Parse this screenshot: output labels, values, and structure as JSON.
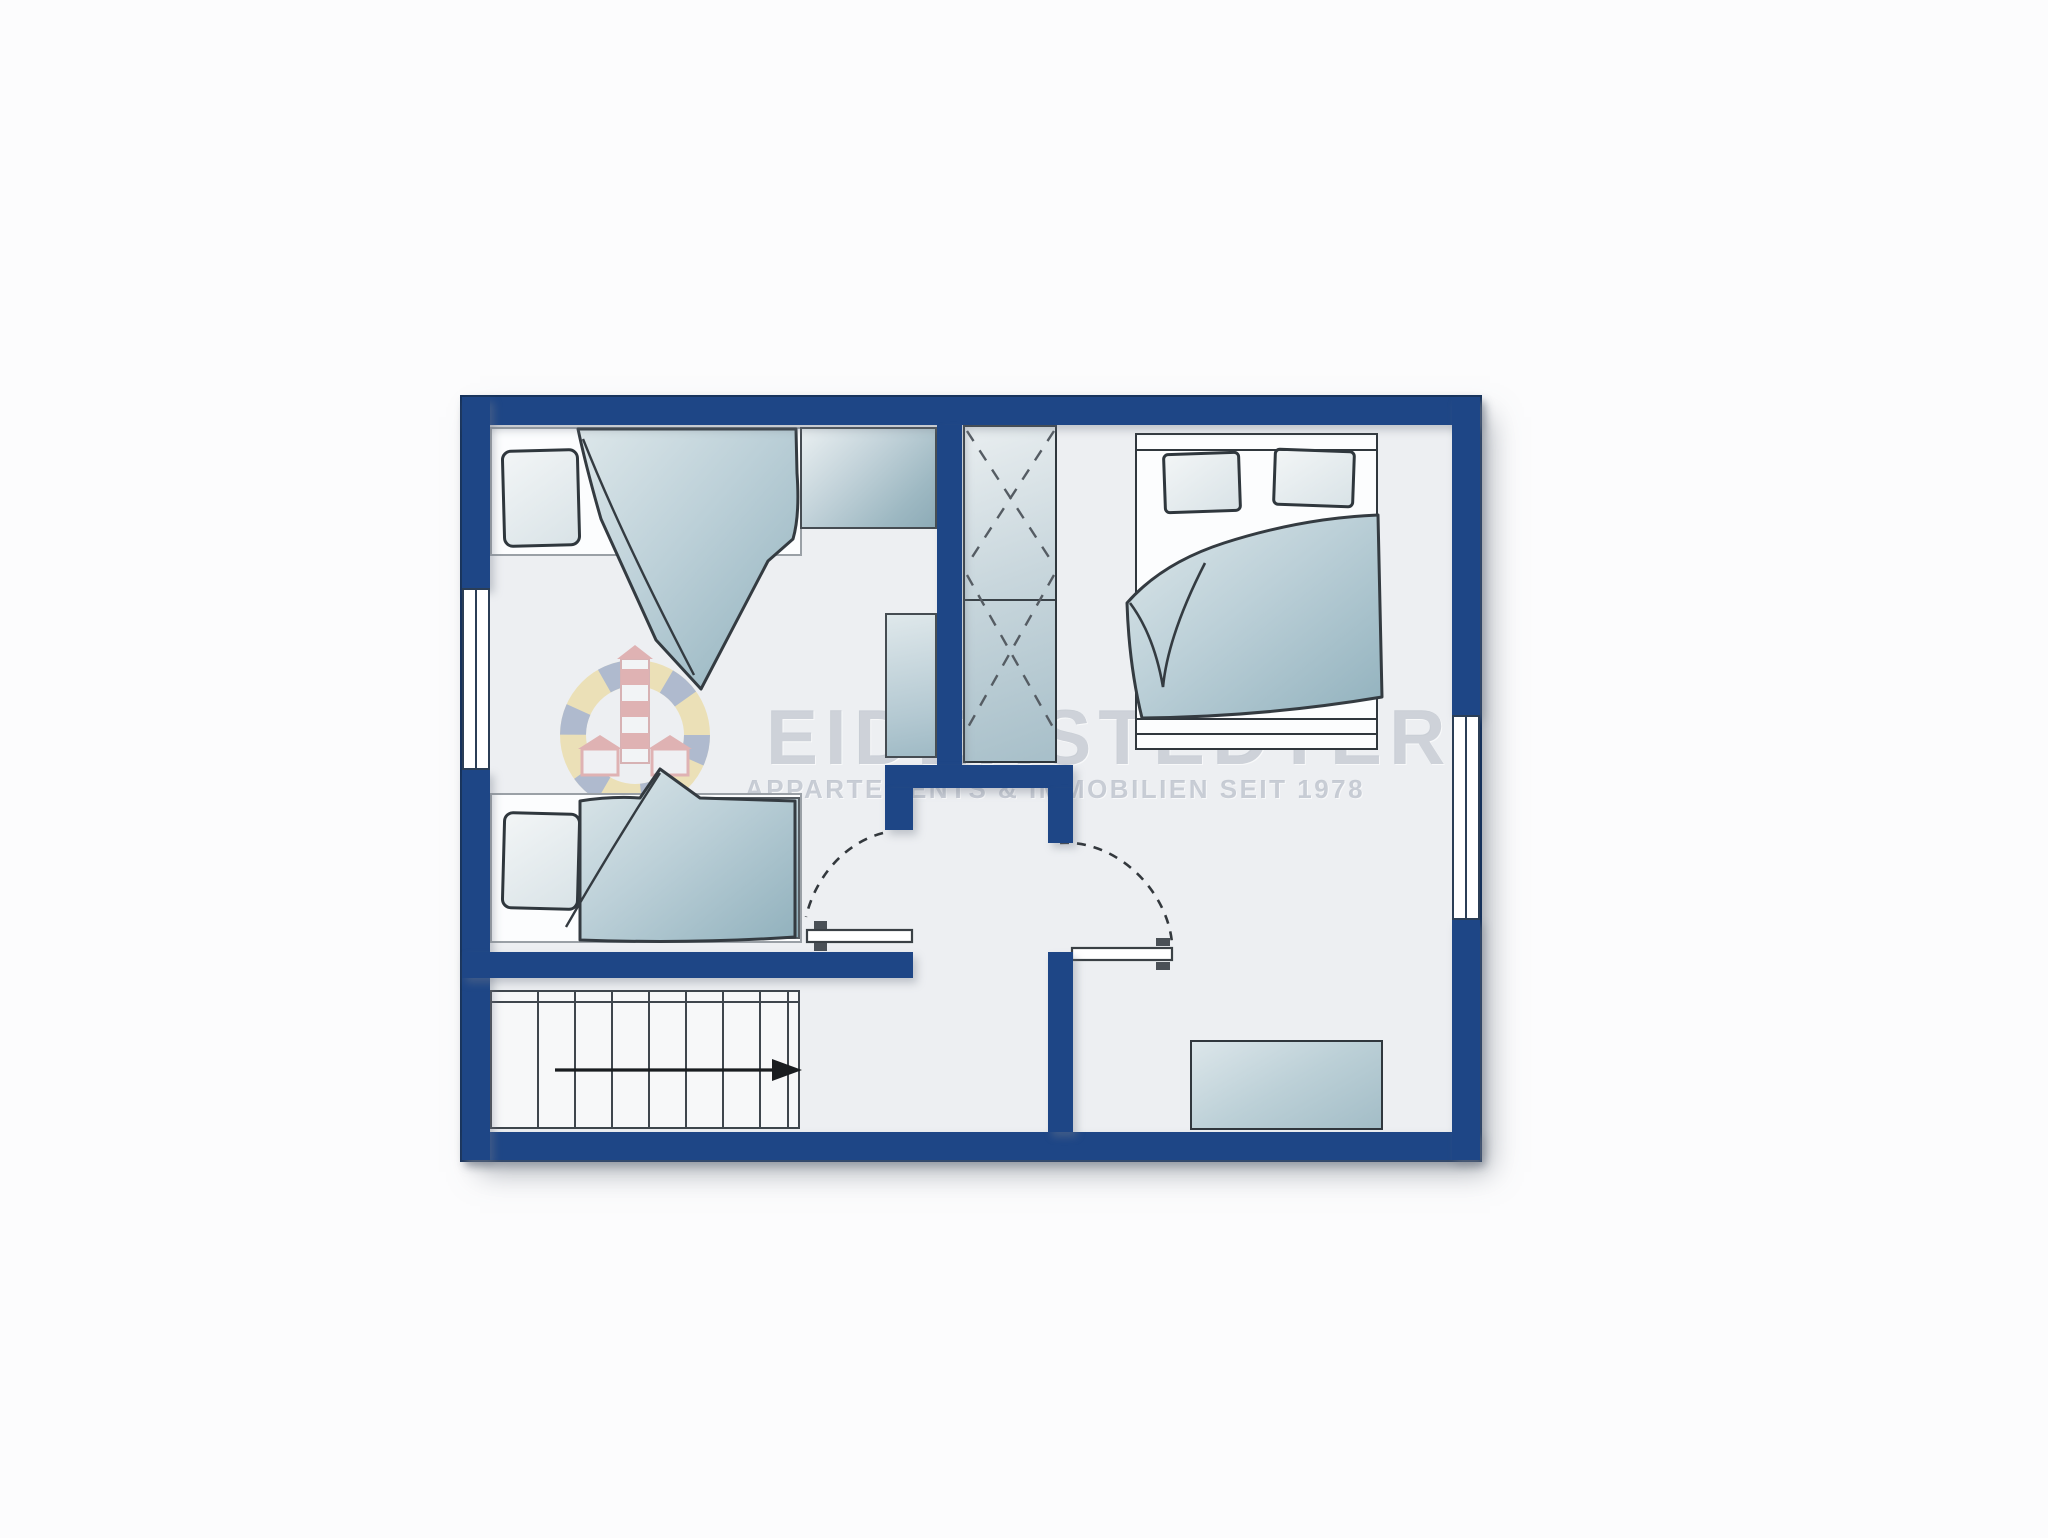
{
  "watermark": {
    "title": "EIDERSTEDTER",
    "subtitle": "APPARTEMENTS & IMMOBILIEN SEIT 1978",
    "logo": "lighthouse-badge-icon"
  },
  "palette": {
    "wall_blue": "#1e4686",
    "wall_outline": "#16325c",
    "floor": "#edeff2",
    "furniture_light": "#e9eff1",
    "furniture_steel": "#8dabb7",
    "ink_outline": "#30373d",
    "watermark_gray": "#abb2be",
    "logo_yellow": "#e8c23f",
    "logo_blue": "#2e4c86",
    "logo_red": "#c23430",
    "background": "#fcfcfd"
  },
  "plan": {
    "type": "floor-plan",
    "storey_elements": {
      "single_beds": 2,
      "double_beds": 1,
      "wardrobe_crossed_cells": 2,
      "dresser": 1,
      "windows": 2,
      "swing_doors": 2,
      "staircase": {
        "tread_lines": 7,
        "arrow_direction": "right"
      }
    }
  }
}
